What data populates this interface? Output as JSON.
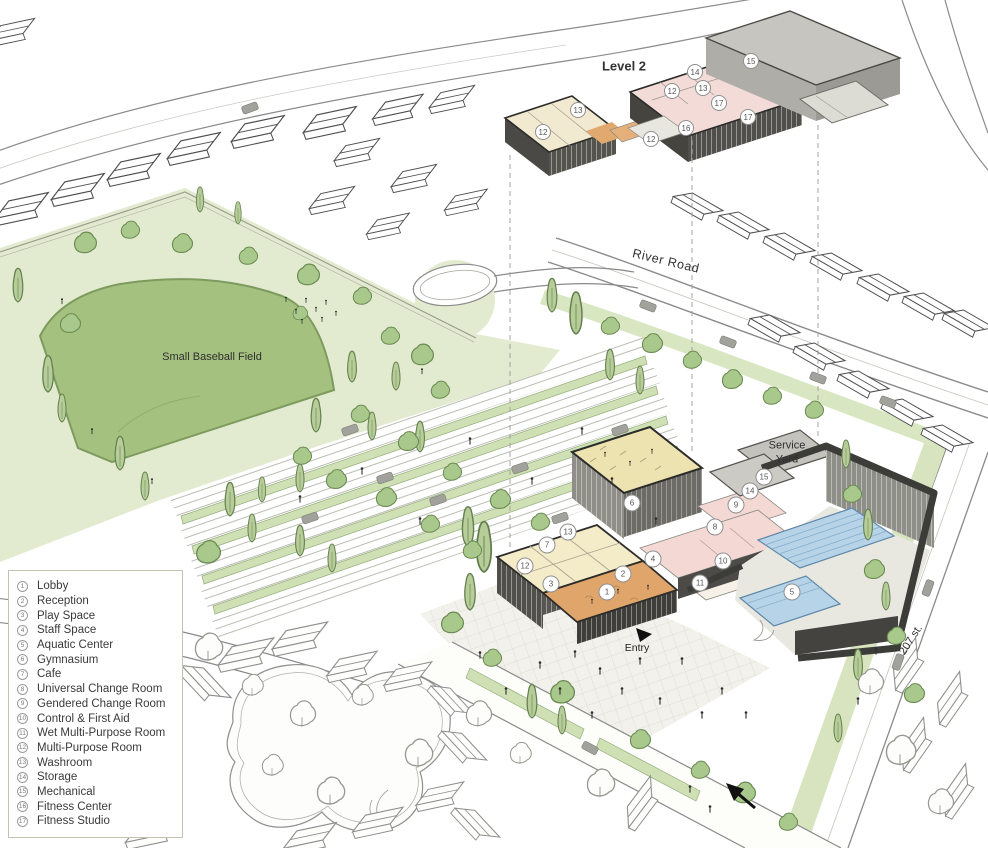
{
  "title": "Community Centre Site Plan Axonometric",
  "labels": {
    "level2": "Level 2",
    "river_road": "River Road",
    "baseball_field": "Small Baseball Field",
    "service_yard": "Service Yard",
    "entry": "Entry",
    "street_207": "207 st."
  },
  "legend": {
    "items": [
      {
        "num": "1",
        "label": "Lobby"
      },
      {
        "num": "2",
        "label": "Reception"
      },
      {
        "num": "3",
        "label": "Play Space"
      },
      {
        "num": "4",
        "label": "Staff Space"
      },
      {
        "num": "5",
        "label": "Aquatic Center"
      },
      {
        "num": "6",
        "label": "Gymnasium"
      },
      {
        "num": "7",
        "label": "Cafe"
      },
      {
        "num": "8",
        "label": "Universal Change Room"
      },
      {
        "num": "9",
        "label": "Gendered Change Room"
      },
      {
        "num": "10",
        "label": "Control & First Aid"
      },
      {
        "num": "11",
        "label": "Wet Multi-Purpose Room"
      },
      {
        "num": "12",
        "label": "Multi-Purpose Room"
      },
      {
        "num": "13",
        "label": "Washroom"
      },
      {
        "num": "14",
        "label": "Storage"
      },
      {
        "num": "15",
        "label": "Mechanical"
      },
      {
        "num": "16",
        "label": "Fitness Center"
      },
      {
        "num": "17",
        "label": "Fitness Studio"
      }
    ]
  },
  "markers": {
    "level1": [
      {
        "n": "1",
        "x": 607,
        "y": 592
      },
      {
        "n": "2",
        "x": 623,
        "y": 574
      },
      {
        "n": "3",
        "x": 551,
        "y": 584
      },
      {
        "n": "4",
        "x": 653,
        "y": 559
      },
      {
        "n": "5",
        "x": 792,
        "y": 592
      },
      {
        "n": "6",
        "x": 632,
        "y": 503
      },
      {
        "n": "7",
        "x": 547,
        "y": 545
      },
      {
        "n": "8",
        "x": 715,
        "y": 527
      },
      {
        "n": "9",
        "x": 736,
        "y": 505
      },
      {
        "n": "10",
        "x": 723,
        "y": 561
      },
      {
        "n": "11",
        "x": 700,
        "y": 583
      },
      {
        "n": "12",
        "x": 525,
        "y": 566
      },
      {
        "n": "13",
        "x": 568,
        "y": 532
      },
      {
        "n": "14",
        "x": 750,
        "y": 491
      },
      {
        "n": "15",
        "x": 764,
        "y": 477
      }
    ],
    "level2": [
      {
        "n": "12",
        "x": 543,
        "y": 132
      },
      {
        "n": "13",
        "x": 578,
        "y": 110
      },
      {
        "n": "12",
        "x": 651,
        "y": 139
      },
      {
        "n": "12",
        "x": 672,
        "y": 91
      },
      {
        "n": "14",
        "x": 695,
        "y": 72
      },
      {
        "n": "13",
        "x": 703,
        "y": 88
      },
      {
        "n": "15",
        "x": 751,
        "y": 61
      },
      {
        "n": "16",
        "x": 686,
        "y": 128
      },
      {
        "n": "17",
        "x": 719,
        "y": 103
      },
      {
        "n": "17",
        "x": 748,
        "y": 117
      }
    ]
  },
  "colors": {
    "park_green": "#e2ebcf",
    "field_green": "#a5c17f",
    "tree_green": "#a9c88b",
    "gym_floor": "#ece3b1",
    "cafe_wing": "#f4ebc9",
    "lobby_orange": "#dfa56b",
    "change_pink": "#f3d8d4",
    "pool_blue": "#b7d3e7",
    "roof_gray": "#c9c8c2",
    "wall_dark": "#4a4948"
  }
}
